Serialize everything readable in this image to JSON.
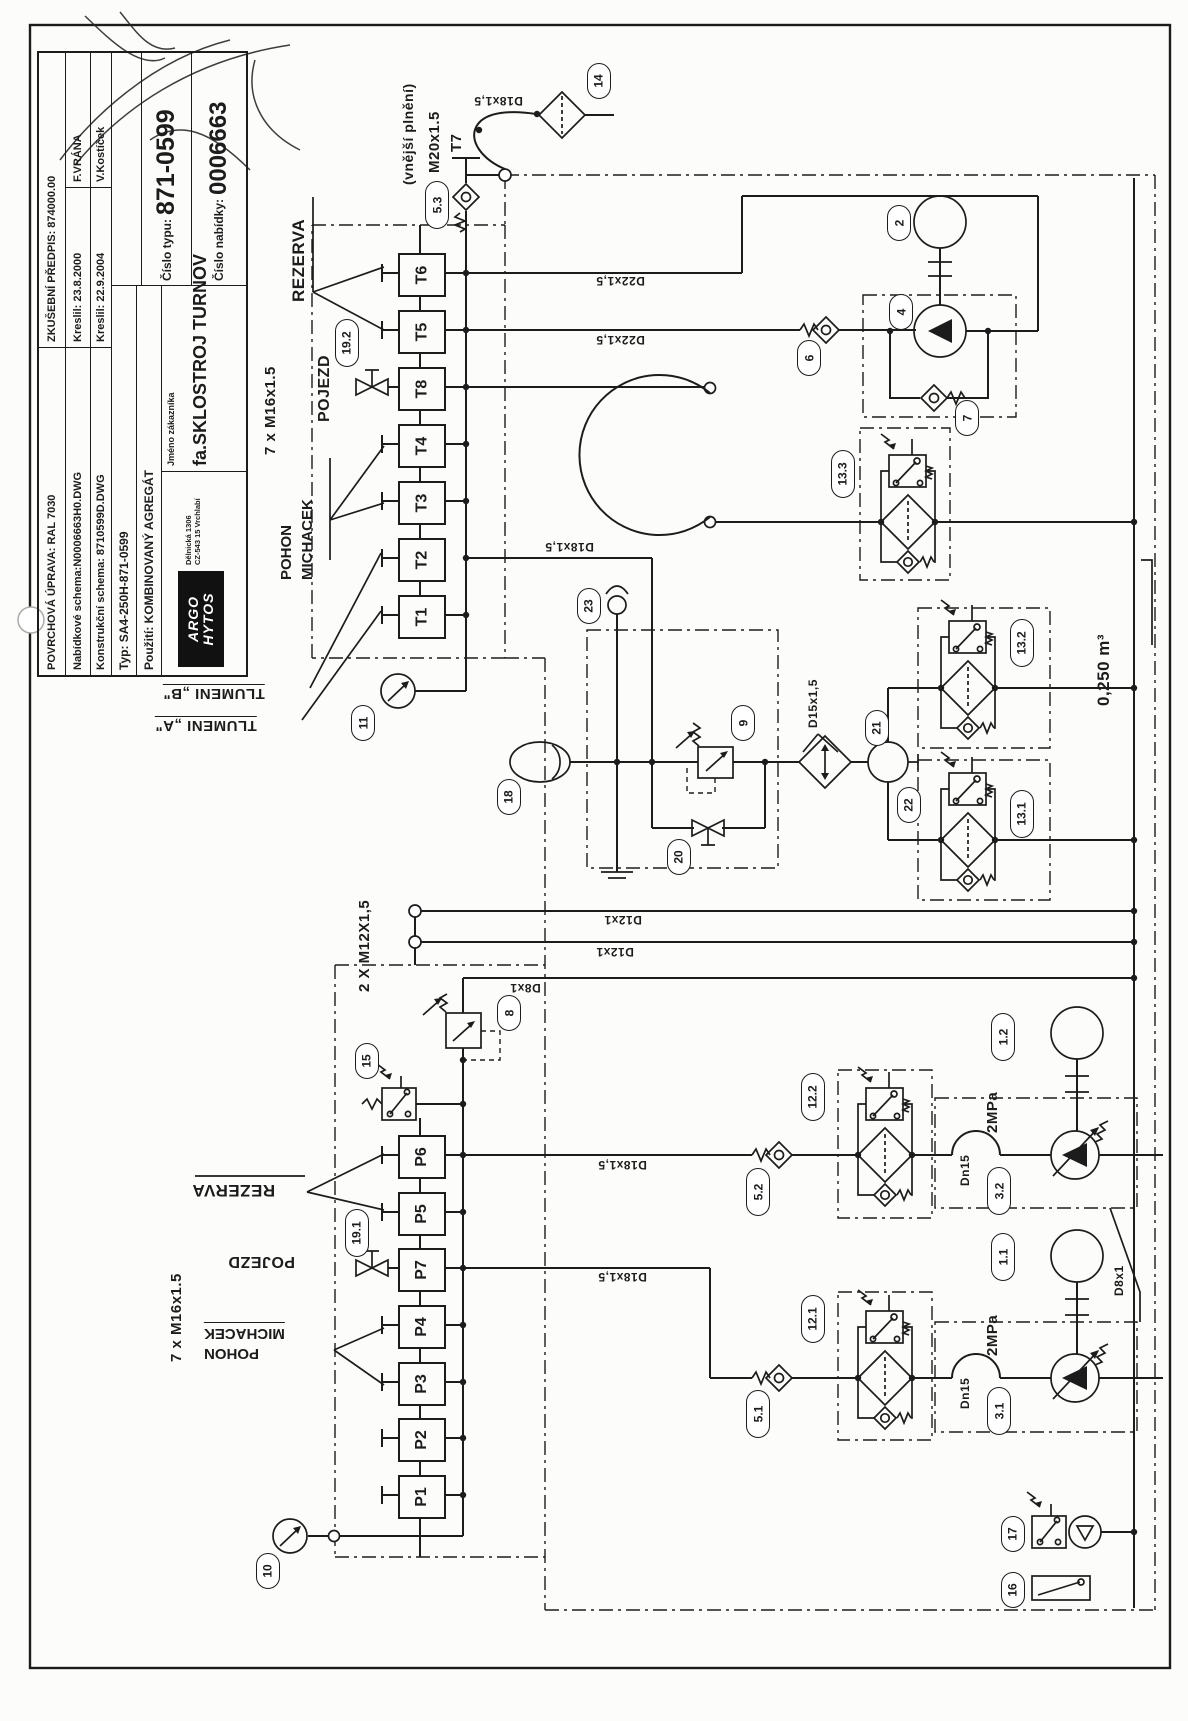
{
  "title_block": {
    "r1l": "POVRCHOVÁ ÚPRAVA: RAL 7030",
    "r1r": "ZKUŠEBNÍ PŘEDPIS: 874000.00",
    "r2l": "Nabídkové schema:N0006663H0.DWG",
    "r2m": "Kreslil: 23.8.2000",
    "r2r": "F.VRÁNA",
    "r3l": "Konstrukční schema: 8710599D.DWG",
    "r3m": "Kreslil: 22.9.2004",
    "r3r": "V.Kostíček",
    "typ": "Typ:  SA4-250H-871-0599",
    "pouziti": "Použití:  KOMBINOVANÝ AGREGÁT",
    "cislo_typu_label": "Číslo typu:",
    "cislo_typu": "871-0599",
    "cislo_nabidky_label": "Číslo nabídky:",
    "cislo_nabidky": "0006663",
    "logo_line1": "ARGO",
    "logo_line2": "HYTOS",
    "logo_addr1": "Dělnická 1306",
    "logo_addr2": "CZ-543 15 Vrchlabí",
    "customer_label": "Jméno zákazníka",
    "customer": "fa.SKLOSTROJ TURNOV"
  },
  "labels": {
    "vnejsi_plneni": "(vnější plnění)",
    "m20": "M20x1.5",
    "t7": "T7",
    "rezerva": "REZERVA",
    "pojezd": "POJEZD",
    "pohon": "POHON",
    "michacek": "MICHACEK",
    "m16": "7 x M16x1.5",
    "m12": "2 X M12X1,5",
    "tlumeni_b": "TLUMENI „B\"",
    "tlumeni_a": "TLUMENI „A\"",
    "d22": "D22x1,5",
    "d18": "D18x1,5",
    "d15": "D15x1,5",
    "d12": "D12x1",
    "d8": "D8x1",
    "dn15": "Dn15",
    "p2mpa": "2MPa",
    "tank_volume": "0,250 m³"
  },
  "ports": {
    "t": [
      "T6",
      "T5",
      "T8",
      "T4",
      "T3",
      "T2",
      "T1"
    ],
    "p": [
      "P6",
      "P5",
      "P7",
      "P4",
      "P3",
      "P2",
      "P1"
    ]
  },
  "components": {
    "n1_1": "1.1",
    "n1_2": "1.2",
    "n2": "2",
    "n3_1": "3.1",
    "n3_2": "3.2",
    "n4": "4",
    "n5_1": "5.1",
    "n5_2": "5.2",
    "n5_3": "5.3",
    "n6": "6",
    "n7": "7",
    "n8": "8",
    "n9": "9",
    "n10": "10",
    "n11": "11",
    "n12_1": "12.1",
    "n12_2": "12.2",
    "n13_1": "13.1",
    "n13_2": "13.2",
    "n13_3": "13.3",
    "n14": "14",
    "n15": "15",
    "n16": "16",
    "n17": "17",
    "n18": "18",
    "n19_1": "19.1",
    "n19_2": "19.2",
    "n20": "20",
    "n21": "21",
    "n22": "22",
    "n23": "23"
  }
}
